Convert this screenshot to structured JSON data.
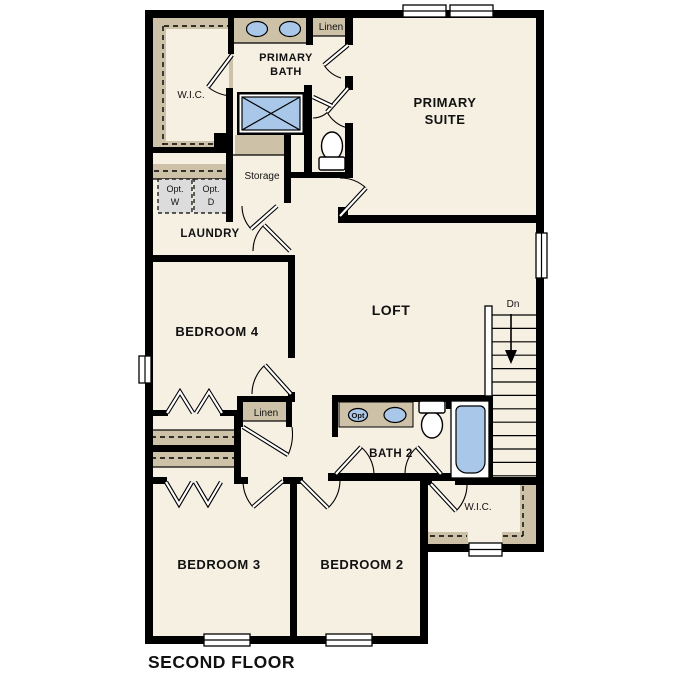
{
  "plan_title": "SECOND FLOOR",
  "colors": {
    "page_background": "#ffffff",
    "floor": "#f6f0e3",
    "accent_tan": "#cdc2a7",
    "fixture_blue": "#a9c7e8",
    "wall_black": "#000000",
    "appliance_gray": "#dcdcdc"
  },
  "rooms": {
    "primary_suite": {
      "line1": "PRIMARY",
      "line2": "SUITE"
    },
    "primary_bath": {
      "line1": "PRIMARY",
      "line2": "BATH"
    },
    "wic_top": {
      "label": "W.I.C."
    },
    "linen_top": {
      "label": "Linen"
    },
    "storage": {
      "label": "Storage"
    },
    "laundry": {
      "label": "LAUNDRY"
    },
    "bedroom_4": {
      "label": "BEDROOM 4"
    },
    "loft": {
      "label": "LOFT"
    },
    "linen_hall": {
      "label": "Linen"
    },
    "bath_2": {
      "label": "BATH 2"
    },
    "wic_bedroom2": {
      "label": "W.I.C."
    },
    "bedroom_3": {
      "label": "BEDROOM 3"
    },
    "bedroom_2": {
      "label": "BEDROOM 2"
    }
  },
  "annotations": {
    "stairs_direction": "Dn",
    "opt_washer": {
      "line1": "Opt.",
      "line2": "W"
    },
    "opt_dryer": {
      "line1": "Opt.",
      "line2": "D"
    },
    "opt_sink": "Opt"
  }
}
